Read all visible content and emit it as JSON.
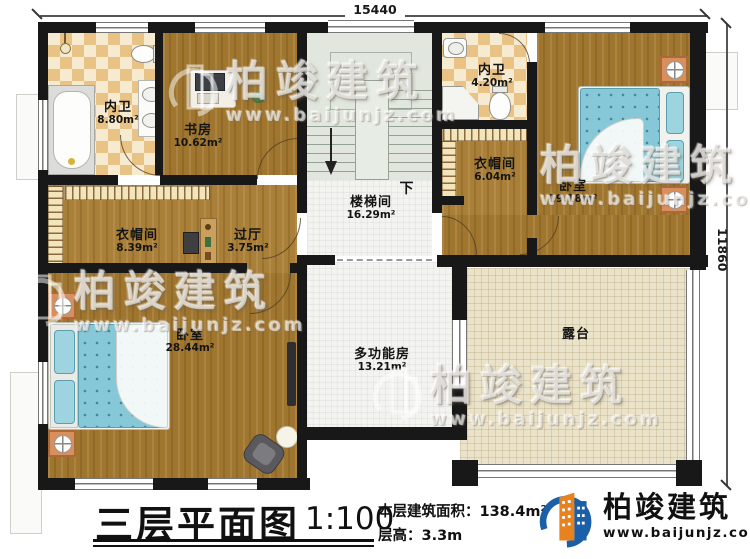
{
  "dimensions": {
    "width_mm": "15440",
    "height_mm": "11860"
  },
  "rooms": [
    {
      "id": "bath-upper-left",
      "name": "内卫",
      "area": "8.80m²"
    },
    {
      "id": "study",
      "name": "书房",
      "area": "10.62m²"
    },
    {
      "id": "bath-upper-right",
      "name": "内卫",
      "area": "4.20m²"
    },
    {
      "id": "cloakroom-right",
      "name": "衣帽间",
      "area": "6.04m²"
    },
    {
      "id": "bedroom-right",
      "name": "卧室",
      "area": "19.18m²"
    },
    {
      "id": "stairwell",
      "name": "楼梯间",
      "area": "16.29m²"
    },
    {
      "id": "cloakroom-left",
      "name": "衣帽间",
      "area": "8.39m²"
    },
    {
      "id": "hallway",
      "name": "过厅",
      "area": "3.75m²"
    },
    {
      "id": "bedroom-left",
      "name": "卧室",
      "area": "28.44m²"
    },
    {
      "id": "multi-room",
      "name": "多功能房",
      "area": "13.21m²"
    },
    {
      "id": "terrace",
      "name": "露台",
      "area": ""
    }
  ],
  "stairs": {
    "down_label": "下"
  },
  "title_block": {
    "title": "三层平面图",
    "scale": "1:100",
    "floor_area": "本层建筑面积：138.4m²",
    "floor_height": "层高：3.3m"
  },
  "brand": {
    "name": "柏竣建筑",
    "website": "www.baijunjz.com"
  },
  "watermark": {
    "text": "柏竣建筑",
    "url": "www.baijunjz.com"
  },
  "colors": {
    "wall": "#181818",
    "wood_floor": "#a0762f",
    "tile_light": "#f6ebd1",
    "tile_dark": "#e9c285",
    "stair": "#e1e7de",
    "terrace": "#ebe3c9",
    "bed": "#86c8d8",
    "nightstand": "#d98f5b",
    "brand_blue": "#1a5fa8",
    "brand_orange": "#e8821e"
  }
}
